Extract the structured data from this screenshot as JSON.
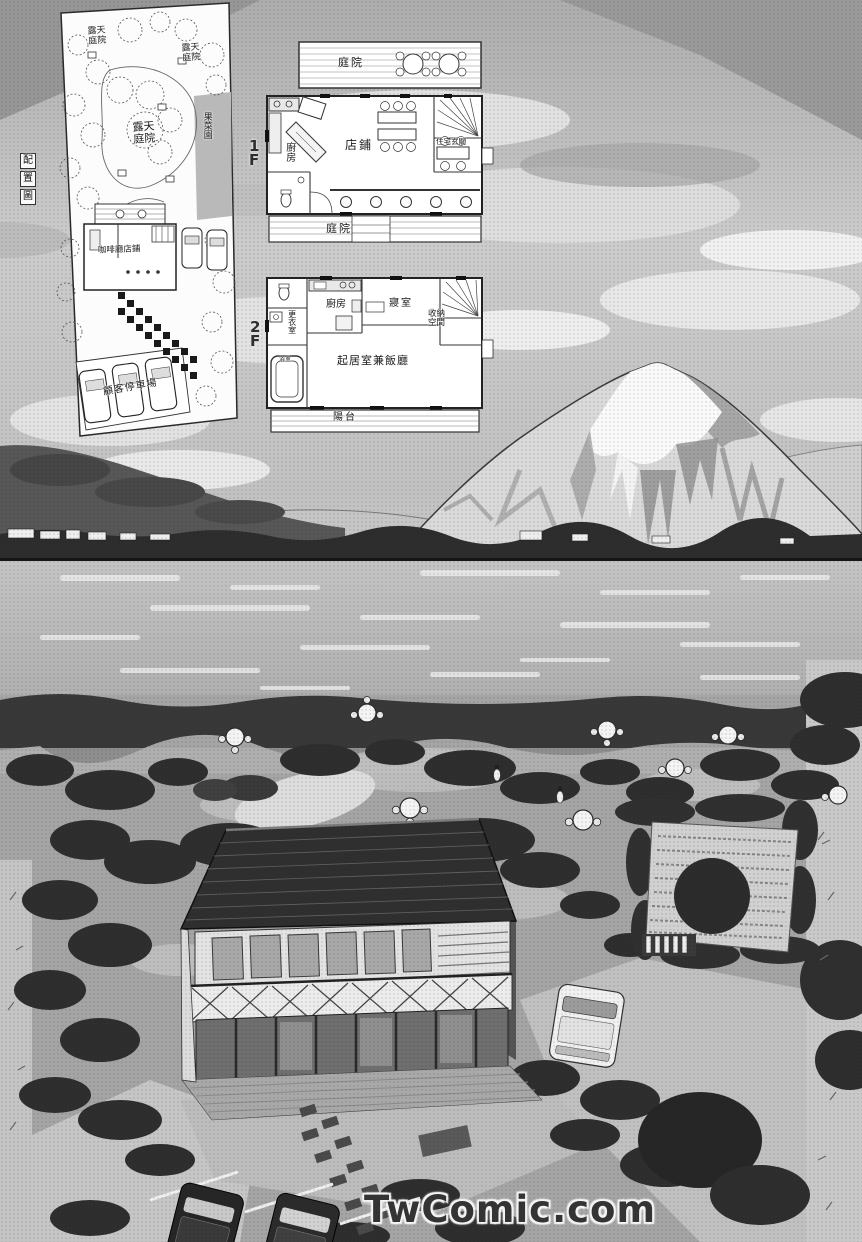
{
  "watermark": "TwComic.com",
  "site_plan": {
    "title_chars": [
      "配",
      "置",
      "圖"
    ],
    "open_air_garden_1": "露天庭院",
    "open_air_garden_2": "露天庭院",
    "open_air_garden_3": "露天庭院",
    "orchard": "果菜園",
    "cafe_shop": "咖啡廳店鋪",
    "customer_parking": "顧客停車場"
  },
  "floor1": {
    "label": "1F",
    "garden_top": "庭院",
    "kitchen": "廚房",
    "shop": "店鋪",
    "residence_entrance": "住宅玄關",
    "garden_bottom": "庭院"
  },
  "floor2": {
    "label": "2F",
    "kitchen": "廚房",
    "bedroom": "寢室",
    "storage": "收納空間",
    "changing_room": "更衣室",
    "bathroom": "浴室",
    "living_dining": "起居室兼飯廳",
    "balcony": "陽台"
  },
  "colors": {
    "paper": "#fcfcfc",
    "ink": "#1b1b1b",
    "sky": "#c6c6c6",
    "watermark_text": "#343434"
  }
}
